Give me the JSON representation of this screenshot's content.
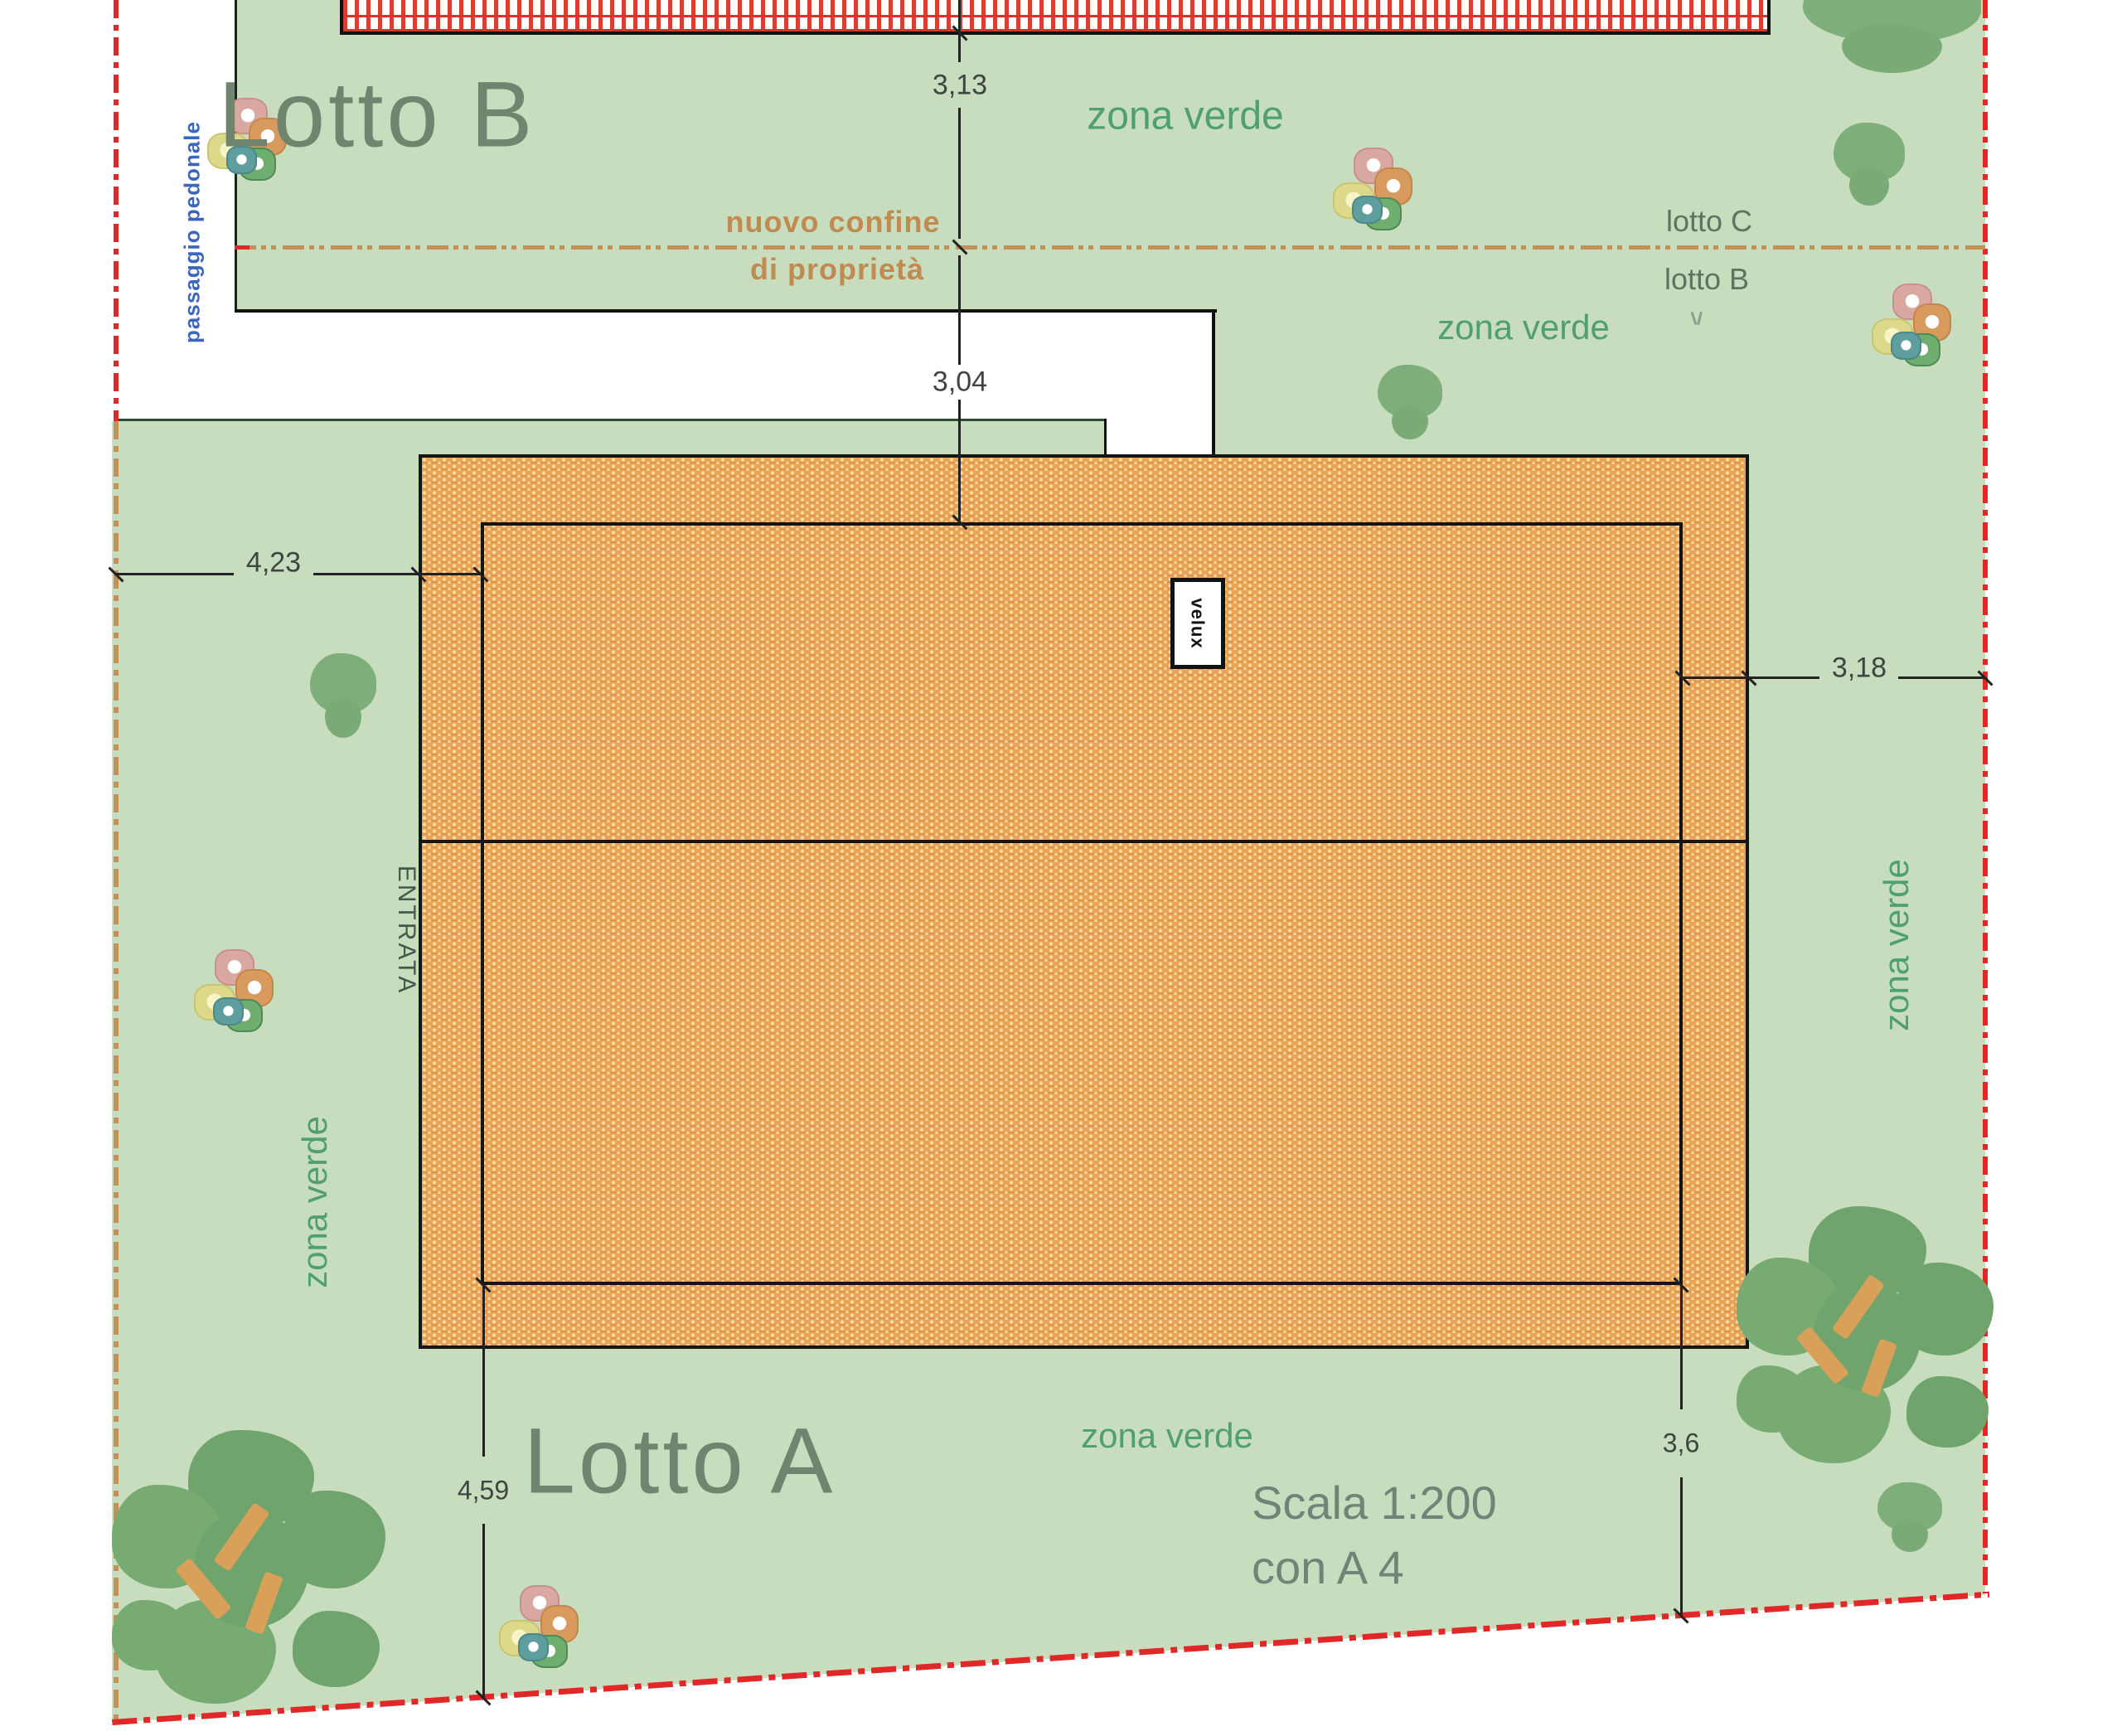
{
  "drawing": {
    "title_block": {
      "scale_line1": "Scala 1:200",
      "scale_line2": "con A 4"
    },
    "lots": {
      "lot_a": "Lotto A",
      "lot_b": "Lotto B",
      "lot_b_small": "lotto B",
      "lot_c_small": "lotto C"
    },
    "labels": {
      "zona_verde": "zona verde",
      "passaggio_pedonale": "passaggio pedonale",
      "entrata": "ENTRATA",
      "velux": "velux",
      "nuovo_confine_line1": "nuovo confine",
      "nuovo_confine_line2": "di proprietà"
    },
    "dimensions": {
      "top_upper": "3,13",
      "top_lower": "3,04",
      "left": "4,23",
      "right": "3,18",
      "bottom_left": "4,59",
      "bottom_right": "3,6"
    },
    "colors": {
      "terrain_green": "#c7ddbd",
      "roof_orange": "#e8a354",
      "boundary_red": "#e02828",
      "boundary_tan": "#c39058",
      "zona_verde_text": "#4f9f70",
      "lot_text": "#70856f",
      "passaggio_blue": "#3c66bd",
      "checker_red": "#d8342a"
    }
  }
}
